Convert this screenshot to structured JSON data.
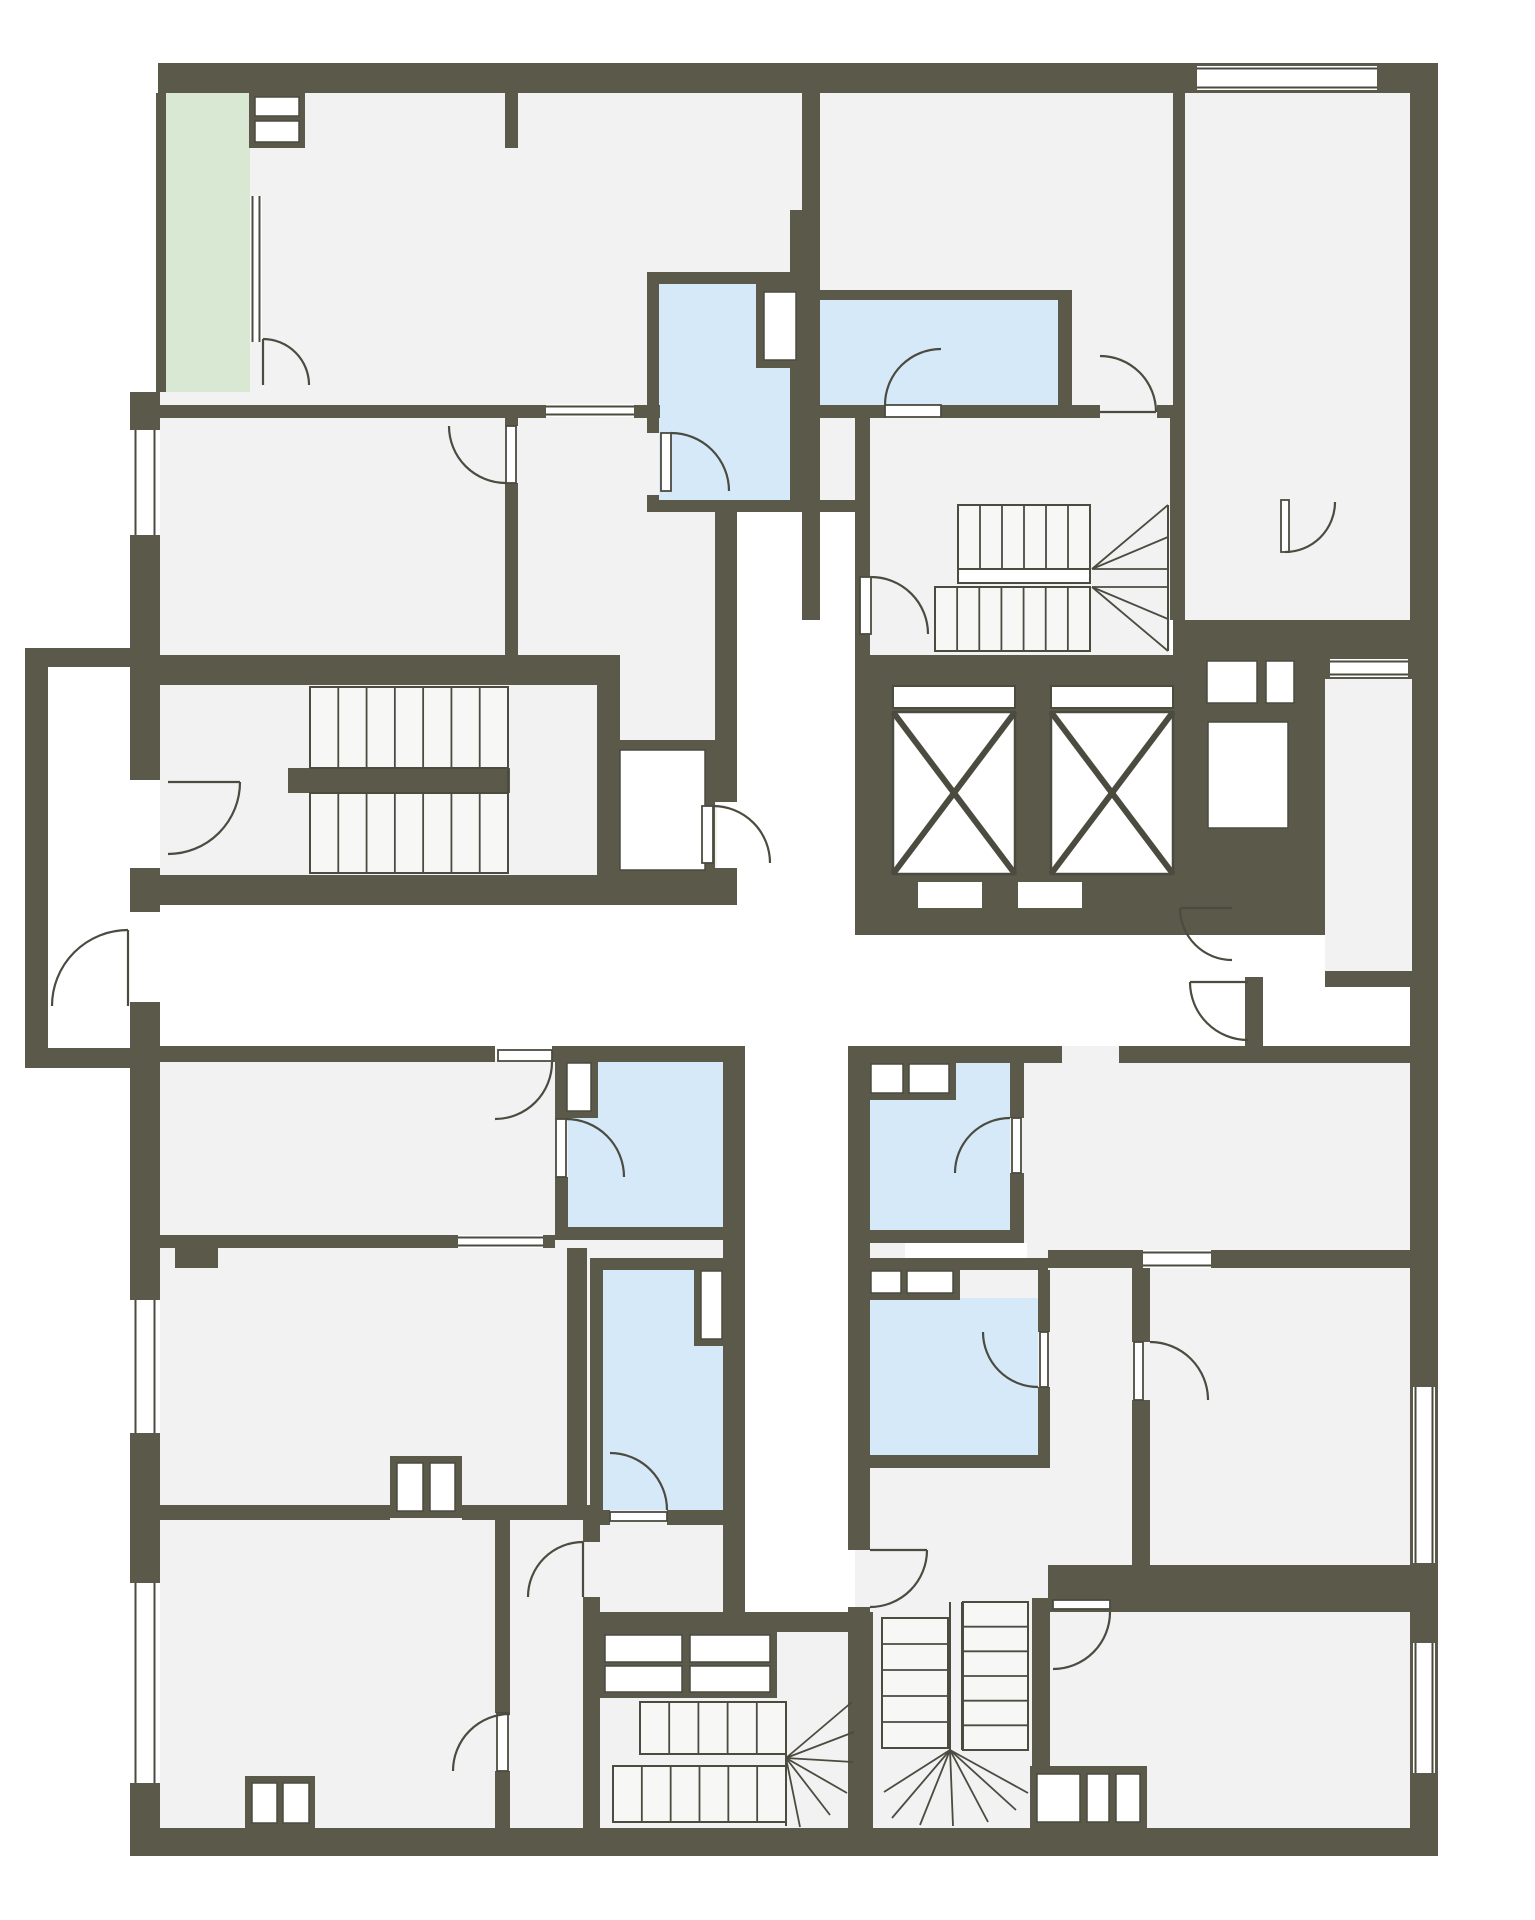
{
  "title": "apartment-floor-plan",
  "canvas": {
    "w": 1535,
    "h": 1920
  },
  "palette": {
    "background": "#ffffff",
    "wall": "#5a594a",
    "line": "#4b4b40",
    "room": "#f1f2f1",
    "wet_room": "#d5e9f9",
    "balcony": "#d9e8d3",
    "stair_fill": "#f7f8f6",
    "white": "#ffffff"
  },
  "legend": {
    "wall": "structural wall",
    "room": "dry room",
    "wet_room": "bathroom / wet room",
    "balcony": "balcony",
    "elevator": "elevator shaft",
    "stairs": "staircase",
    "door": "door swing",
    "window": "window"
  },
  "base_rooms": [
    [
      160,
      93,
      1250,
      325
    ],
    [
      160,
      418,
      557,
      487
    ],
    [
      820,
      418,
      350,
      237
    ],
    [
      1185,
      418,
      225,
      237
    ],
    [
      160,
      1060,
      585,
      770
    ],
    [
      855,
      1046,
      555,
      784
    ],
    [
      718,
      1632,
      155,
      196
    ]
  ],
  "balcony_rooms": [
    [
      166,
      93,
      84,
      299
    ]
  ],
  "corridors": [
    [
      160,
      905,
      1250,
      141
    ],
    [
      737,
      512,
      118,
      393
    ],
    [
      745,
      1046,
      103,
      574
    ],
    [
      48,
      667,
      82,
      381
    ]
  ],
  "wet_rooms": [
    [
      659,
      284,
      131,
      216
    ],
    [
      820,
      300,
      238,
      105
    ],
    [
      568,
      1062,
      155,
      165
    ],
    [
      870,
      1063,
      140,
      167
    ],
    [
      603,
      1270,
      120,
      240
    ],
    [
      870,
      1298,
      168,
      159
    ]
  ],
  "walls": [
    [
      158,
      63,
      1280,
      30
    ],
    [
      156,
      93,
      10,
      299
    ],
    [
      130,
      392,
      30,
      38
    ],
    [
      130,
      535,
      30,
      245
    ],
    [
      130,
      868,
      30,
      44
    ],
    [
      130,
      1002,
      30,
      298
    ],
    [
      130,
      1433,
      30,
      150
    ],
    [
      130,
      1783,
      30,
      73
    ],
    [
      1410,
      63,
      28,
      1793
    ],
    [
      130,
      1828,
      1308,
      28
    ],
    [
      25,
      648,
      105,
      19
    ],
    [
      25,
      648,
      23,
      420
    ],
    [
      25,
      1048,
      105,
      20
    ],
    [
      160,
      405,
      386,
      13
    ],
    [
      634,
      405,
      26,
      13
    ],
    [
      802,
      405,
      83,
      13
    ],
    [
      941,
      405,
      159,
      13
    ],
    [
      1157,
      405,
      28,
      13
    ],
    [
      505,
      93,
      13,
      55
    ],
    [
      505,
      414,
      13,
      12
    ],
    [
      505,
      483,
      13,
      172
    ],
    [
      160,
      655,
      445,
      30
    ],
    [
      597,
      655,
      23,
      250
    ],
    [
      715,
      512,
      22,
      290
    ],
    [
      715,
      868,
      22,
      37
    ],
    [
      647,
      284,
      12,
      149
    ],
    [
      647,
      495,
      12,
      17
    ],
    [
      647,
      272,
      143,
      12
    ],
    [
      647,
      500,
      223,
      12
    ],
    [
      790,
      210,
      14,
      302
    ],
    [
      802,
      93,
      18,
      527
    ],
    [
      802,
      290,
      268,
      10
    ],
    [
      1058,
      290,
      14,
      128
    ],
    [
      1173,
      93,
      12,
      325
    ],
    [
      1173,
      620,
      237,
      35
    ],
    [
      855,
      418,
      15,
      240
    ],
    [
      1170,
      418,
      15,
      202
    ],
    [
      855,
      655,
      345,
      280
    ],
    [
      1183,
      655,
      227,
      280
    ],
    [
      288,
      768,
      222,
      25
    ],
    [
      130,
      875,
      585,
      30
    ],
    [
      160,
      1046,
      335,
      16
    ],
    [
      552,
      1046,
      171,
      16
    ],
    [
      555,
      1062,
      13,
      57
    ],
    [
      555,
      1177,
      13,
      53
    ],
    [
      555,
      1227,
      190,
      13
    ],
    [
      723,
      1046,
      22,
      574
    ],
    [
      848,
      1046,
      22,
      504
    ],
    [
      848,
      1607,
      22,
      13
    ],
    [
      160,
      1235,
      298,
      13
    ],
    [
      543,
      1235,
      12,
      13
    ],
    [
      175,
      1248,
      43,
      20
    ],
    [
      567,
      1248,
      20,
      272
    ],
    [
      590,
      1258,
      13,
      262
    ],
    [
      590,
      1258,
      137,
      12
    ],
    [
      590,
      1510,
      20,
      15
    ],
    [
      667,
      1510,
      78,
      15
    ],
    [
      583,
      1612,
      290,
      20
    ],
    [
      160,
      1505,
      230,
      15
    ],
    [
      462,
      1505,
      128,
      15
    ],
    [
      495,
      1520,
      15,
      193
    ],
    [
      495,
      1771,
      15,
      57
    ],
    [
      583,
      1520,
      17,
      22
    ],
    [
      583,
      1597,
      17,
      15
    ],
    [
      583,
      1632,
      17,
      196
    ],
    [
      848,
      1620,
      25,
      212
    ],
    [
      1032,
      1598,
      18,
      230
    ],
    [
      870,
      1046,
      192,
      17
    ],
    [
      1119,
      1046,
      291,
      17
    ],
    [
      1010,
      1063,
      14,
      55
    ],
    [
      1010,
      1173,
      14,
      70
    ],
    [
      870,
      1230,
      154,
      13
    ],
    [
      848,
      1258,
      200,
      12
    ],
    [
      1038,
      1270,
      12,
      62
    ],
    [
      1038,
      1387,
      12,
      73
    ],
    [
      848,
      1455,
      202,
      13
    ],
    [
      1132,
      1250,
      18,
      92
    ],
    [
      1132,
      1400,
      18,
      165
    ],
    [
      1048,
      1250,
      95,
      18
    ],
    [
      1211,
      1250,
      199,
      18
    ],
    [
      1048,
      1565,
      362,
      47
    ]
  ],
  "over_rooms": [
    [
      1325,
      679,
      87,
      294
    ]
  ],
  "over_walls": [
    [
      1325,
      971,
      87,
      16
    ],
    [
      1245,
      977,
      18,
      71
    ]
  ],
  "niches": [
    [
      918,
      882,
      64,
      26
    ],
    [
      1018,
      882,
      64,
      26
    ],
    [
      905,
      1243,
      122,
      15
    ]
  ],
  "boxes": [
    {
      "f": [
        249,
        91,
        56,
        57
      ],
      "c": [
        [
          255,
          97,
          44,
          19
        ],
        [
          255,
          121,
          44,
          21
        ]
      ]
    },
    {
      "f": [
        756,
        284,
        48,
        84
      ],
      "c": [
        [
          764,
          292,
          32,
          68
        ]
      ]
    },
    {
      "f": [
        560,
        1056,
        38,
        62
      ],
      "c": [
        [
          567,
          1063,
          24,
          48
        ]
      ]
    },
    {
      "f": [
        694,
        1264,
        35,
        82
      ],
      "c": [
        [
          701,
          1271,
          21,
          68
        ]
      ]
    },
    {
      "f": [
        864,
        1057,
        92,
        43
      ],
      "c": [
        [
          871,
          1064,
          32,
          29
        ],
        [
          909,
          1064,
          40,
          29
        ]
      ]
    },
    {
      "f": [
        864,
        1264,
        96,
        36
      ],
      "c": [
        [
          871,
          1271,
          30,
          22
        ],
        [
          907,
          1271,
          46,
          22
        ]
      ]
    },
    {
      "f": [
        390,
        1456,
        72,
        62
      ],
      "c": [
        [
          397,
          1463,
          26,
          48
        ],
        [
          430,
          1463,
          25,
          48
        ]
      ]
    },
    {
      "f": [
        245,
        1776,
        70,
        52
      ],
      "c": [
        [
          252,
          1783,
          25,
          40
        ],
        [
          283,
          1783,
          26,
          40
        ]
      ]
    },
    {
      "f": [
        1030,
        1766,
        117,
        62
      ],
      "c": [
        [
          1037,
          1774,
          43,
          48
        ],
        [
          1087,
          1774,
          22,
          48
        ],
        [
          1116,
          1774,
          24,
          48
        ]
      ]
    },
    {
      "f": [
        597,
        1628,
        180,
        70
      ],
      "c": [
        [
          605,
          1635,
          77,
          27
        ],
        [
          605,
          1666,
          77,
          26
        ],
        [
          690,
          1635,
          80,
          27
        ],
        [
          690,
          1666,
          80,
          26
        ]
      ]
    },
    {
      "f": [
        1200,
        654,
        64,
        56
      ],
      "c": [
        [
          1207,
          661,
          50,
          42
        ]
      ]
    },
    {
      "f": [
        1260,
        654,
        40,
        56
      ],
      "c": [
        [
          1266,
          661,
          28,
          42
        ]
      ]
    },
    {
      "f": [
        1198,
        712,
        100,
        126
      ],
      "c": [
        [
          1208,
          722,
          80,
          106
        ]
      ]
    },
    {
      "f": [
        610,
        740,
        105,
        140
      ],
      "c": [
        [
          620,
          750,
          85,
          120
        ]
      ]
    }
  ],
  "windows": [
    {
      "r": [
        1197,
        66,
        180,
        24
      ],
      "d": "h"
    },
    {
      "r": [
        133,
        430,
        24,
        105
      ],
      "d": "v"
    },
    {
      "r": [
        133,
        1300,
        24,
        133
      ],
      "d": "v"
    },
    {
      "r": [
        133,
        1583,
        24,
        200
      ],
      "d": "v"
    },
    {
      "r": [
        1413,
        1387,
        22,
        176
      ],
      "d": "v"
    },
    {
      "r": [
        1413,
        1643,
        22,
        130
      ],
      "d": "v"
    },
    {
      "r": [
        546,
        404,
        88,
        13
      ],
      "d": "h"
    },
    {
      "r": [
        458,
        1235,
        85,
        13
      ],
      "d": "h"
    },
    {
      "r": [
        1143,
        1250,
        68,
        18
      ],
      "d": "h"
    },
    {
      "r": [
        1330,
        659,
        78,
        18
      ],
      "d": "h"
    },
    {
      "r": [
        250,
        196,
        12,
        146
      ],
      "d": "v"
    }
  ],
  "elevators": [
    {
      "slit": [
        893,
        686,
        122,
        22
      ],
      "cab": [
        893,
        712,
        122,
        162
      ]
    },
    {
      "slit": [
        1051,
        686,
        122,
        22
      ],
      "cab": [
        1051,
        712,
        122,
        162
      ]
    }
  ],
  "stairs": {
    "flights": [
      [
        310,
        687,
        198,
        81,
        "h",
        7
      ],
      [
        310,
        793,
        198,
        80,
        "h",
        7
      ],
      [
        958,
        505,
        132,
        64,
        "h",
        6
      ],
      [
        935,
        587,
        155,
        64,
        "h",
        7
      ],
      [
        640,
        1702,
        146,
        52,
        "h",
        5
      ],
      [
        613,
        1766,
        173,
        56,
        "h",
        6
      ],
      [
        882,
        1618,
        66,
        130,
        "v",
        5
      ],
      [
        963,
        1602,
        65,
        148,
        "v",
        6
      ]
    ],
    "rails": [
      [
        958,
        569,
        132,
        14
      ]
    ],
    "fans": [
      {
        "p": [
          1092,
          569
        ],
        "pts": [
          [
            1168,
            505
          ],
          [
            1168,
            537
          ],
          [
            1168,
            569
          ]
        ]
      },
      {
        "p": [
          1092,
          587
        ],
        "pts": [
          [
            1168,
            587
          ],
          [
            1168,
            619
          ],
          [
            1168,
            651
          ]
        ]
      },
      {
        "p": [
          786,
          1758
        ],
        "pts": [
          [
            852,
            1702
          ],
          [
            854,
            1732
          ],
          [
            853,
            1762
          ],
          [
            847,
            1793
          ],
          [
            830,
            1815
          ],
          [
            800,
            1827
          ]
        ]
      },
      {
        "p": [
          950,
          1750
        ],
        "pts": [
          [
            884,
            1792
          ],
          [
            892,
            1818
          ],
          [
            920,
            1825
          ],
          [
            953,
            1826
          ],
          [
            988,
            1822
          ],
          [
            1016,
            1810
          ],
          [
            1028,
            1793
          ]
        ]
      }
    ],
    "lines": [
      [
        1168,
        505,
        1168,
        651
      ],
      [
        950,
        1602,
        950,
        1750
      ],
      [
        962,
        1602,
        962,
        1750
      ],
      [
        786,
        1702,
        786,
        1826
      ],
      [
        508,
        687,
        508,
        873
      ]
    ]
  },
  "doors": [
    {
      "c": [
        263,
        385
      ],
      "r": 46,
      "a1": 270,
      "a2": 360,
      "s": 1,
      "leaf": null
    },
    {
      "c": [
        506,
        426
      ],
      "r": 57,
      "a1": 90,
      "a2": 180,
      "s": 1,
      "leaf": [
        506,
        426,
        10,
        57
      ]
    },
    {
      "c": [
        671,
        491
      ],
      "r": 58,
      "a1": 270,
      "a2": 360,
      "s": 1,
      "leaf": [
        661,
        433,
        10,
        58
      ]
    },
    {
      "c": [
        941,
        405
      ],
      "r": 56,
      "a1": 180,
      "a2": 270,
      "s": 1,
      "leaf": [
        885,
        405,
        56,
        12
      ]
    },
    {
      "c": [
        1100,
        412
      ],
      "r": 56,
      "a1": 360,
      "a2": 270,
      "s": 0,
      "leaf": null
    },
    {
      "c": [
        1285,
        502
      ],
      "r": 50,
      "a1": 90,
      "a2": 0,
      "s": 0,
      "leaf": [
        1281,
        500,
        8,
        52
      ]
    },
    {
      "c": [
        871,
        634
      ],
      "r": 57,
      "a1": 270,
      "a2": 360,
      "s": 1,
      "leaf": [
        860,
        577,
        11,
        57
      ]
    },
    {
      "c": [
        713,
        863
      ],
      "r": 57,
      "a1": 270,
      "a2": 360,
      "s": 1,
      "leaf": [
        702,
        806,
        11,
        57
      ]
    },
    {
      "c": [
        168,
        782
      ],
      "r": 72,
      "a1": 0,
      "a2": 90,
      "s": 1,
      "leaf": null
    },
    {
      "c": [
        128,
        1006
      ],
      "r": 76,
      "a1": 270,
      "a2": 180,
      "s": 0,
      "leaf": null
    },
    {
      "c": [
        1232,
        908
      ],
      "r": 52,
      "a1": 180,
      "a2": 90,
      "s": 0,
      "leaf": null
    },
    {
      "c": [
        1248,
        982
      ],
      "r": 58,
      "a1": 180,
      "a2": 90,
      "s": 0,
      "leaf": null
    },
    {
      "c": [
        495,
        1062
      ],
      "r": 57,
      "a1": 0,
      "a2": 90,
      "s": 1,
      "leaf": [
        498,
        1050,
        54,
        11
      ]
    },
    {
      "c": [
        566,
        1177
      ],
      "r": 58,
      "a1": 270,
      "a2": 360,
      "s": 1,
      "leaf": [
        556,
        1119,
        10,
        58
      ]
    },
    {
      "c": [
        610,
        1510
      ],
      "r": 57,
      "a1": 0,
      "a2": -90,
      "s": 0,
      "leaf": [
        610,
        1512,
        57,
        9
      ]
    },
    {
      "c": [
        1010,
        1173
      ],
      "r": 55,
      "a1": 270,
      "a2": 180,
      "s": 0,
      "leaf": [
        1012,
        1118,
        9,
        55
      ]
    },
    {
      "c": [
        1038,
        1332
      ],
      "r": 55,
      "a1": 180,
      "a2": 90,
      "s": 0,
      "leaf": [
        1040,
        1332,
        8,
        55
      ]
    },
    {
      "c": [
        1150,
        1400
      ],
      "r": 58,
      "a1": 270,
      "a2": 360,
      "s": 1,
      "leaf": [
        1134,
        1342,
        9,
        58
      ]
    },
    {
      "c": [
        1053,
        1612
      ],
      "r": 57,
      "a1": 0,
      "a2": 90,
      "s": 1,
      "leaf": [
        1053,
        1600,
        57,
        9
      ]
    },
    {
      "c": [
        510,
        1771
      ],
      "r": 57,
      "a1": 270,
      "a2": 180,
      "s": 0,
      "leaf": [
        497,
        1713,
        11,
        58
      ]
    },
    {
      "c": [
        583,
        1597
      ],
      "r": 55,
      "a1": 270,
      "a2": 180,
      "s": 0,
      "leaf": null
    },
    {
      "c": [
        870,
        1550
      ],
      "r": 57,
      "a1": 0,
      "a2": 90,
      "s": 1,
      "leaf": null
    }
  ]
}
